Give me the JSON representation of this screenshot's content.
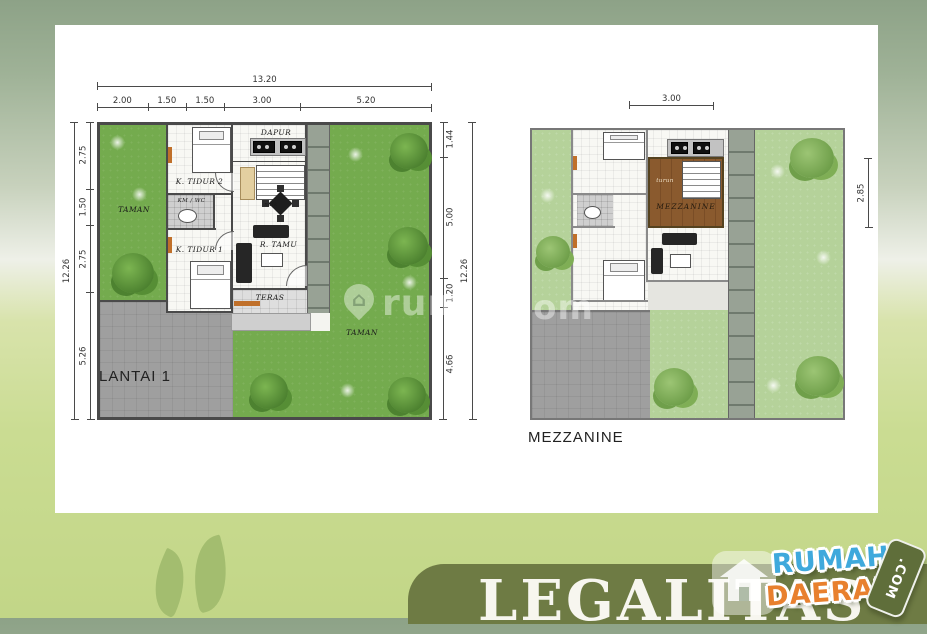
{
  "floor1": {
    "title": "LANTAI 1",
    "dims": {
      "top_total": "13.20",
      "top_segments": [
        "2.00",
        "1.50",
        "1.50",
        "3.00",
        "5.20"
      ],
      "left_total": "12.26",
      "left_segments": [
        "2.75",
        "1.50",
        "2.75",
        "5.26"
      ],
      "right_total": "12.26",
      "right_segments": [
        "1.44",
        "5.00",
        "1.20",
        "4.66"
      ],
      "bottom_total": "13.39",
      "bottom_segments": [
        "2.00",
        "3.00",
        "3.00",
        "5.39"
      ]
    },
    "rooms": {
      "taman_left": "TAMAN",
      "k_tidur_2": "K. TIDUR 2",
      "km_wc": "KM / WC",
      "k_tidur_1": "K. TIDUR 1",
      "dapur": "DAPUR",
      "naik": "naik",
      "r_tamu": "R. TAMU",
      "teras": "TERAS",
      "taman_right": "TAMAN"
    }
  },
  "floor2": {
    "title": "MEZZANINE",
    "dims": {
      "top": "3.00",
      "right": "2.85"
    },
    "rooms": {
      "mezzanine": "MEZZANINE",
      "turun": "turun"
    }
  },
  "watermark": {
    "icon": "house-pin",
    "text_left": "rum",
    "text_right": "com"
  },
  "banner": {
    "text": "LEGALITAS",
    "color": "#6e7b44"
  },
  "logo": {
    "line1": "RUMAH",
    "line2": "DAERAH",
    "tag": ".COM",
    "blue": "#3fa9dc",
    "orange": "#e8802e"
  },
  "colors": {
    "background_top": "#8da287",
    "background_bottom": "#cadc92",
    "garden_dark": "#74ab4e",
    "garden_light": "#b5d29a",
    "carport": "#9f9f9f",
    "wall": "#4a4a4a",
    "wood": "#8a5a2e",
    "accent_orange": "#c0702a"
  }
}
